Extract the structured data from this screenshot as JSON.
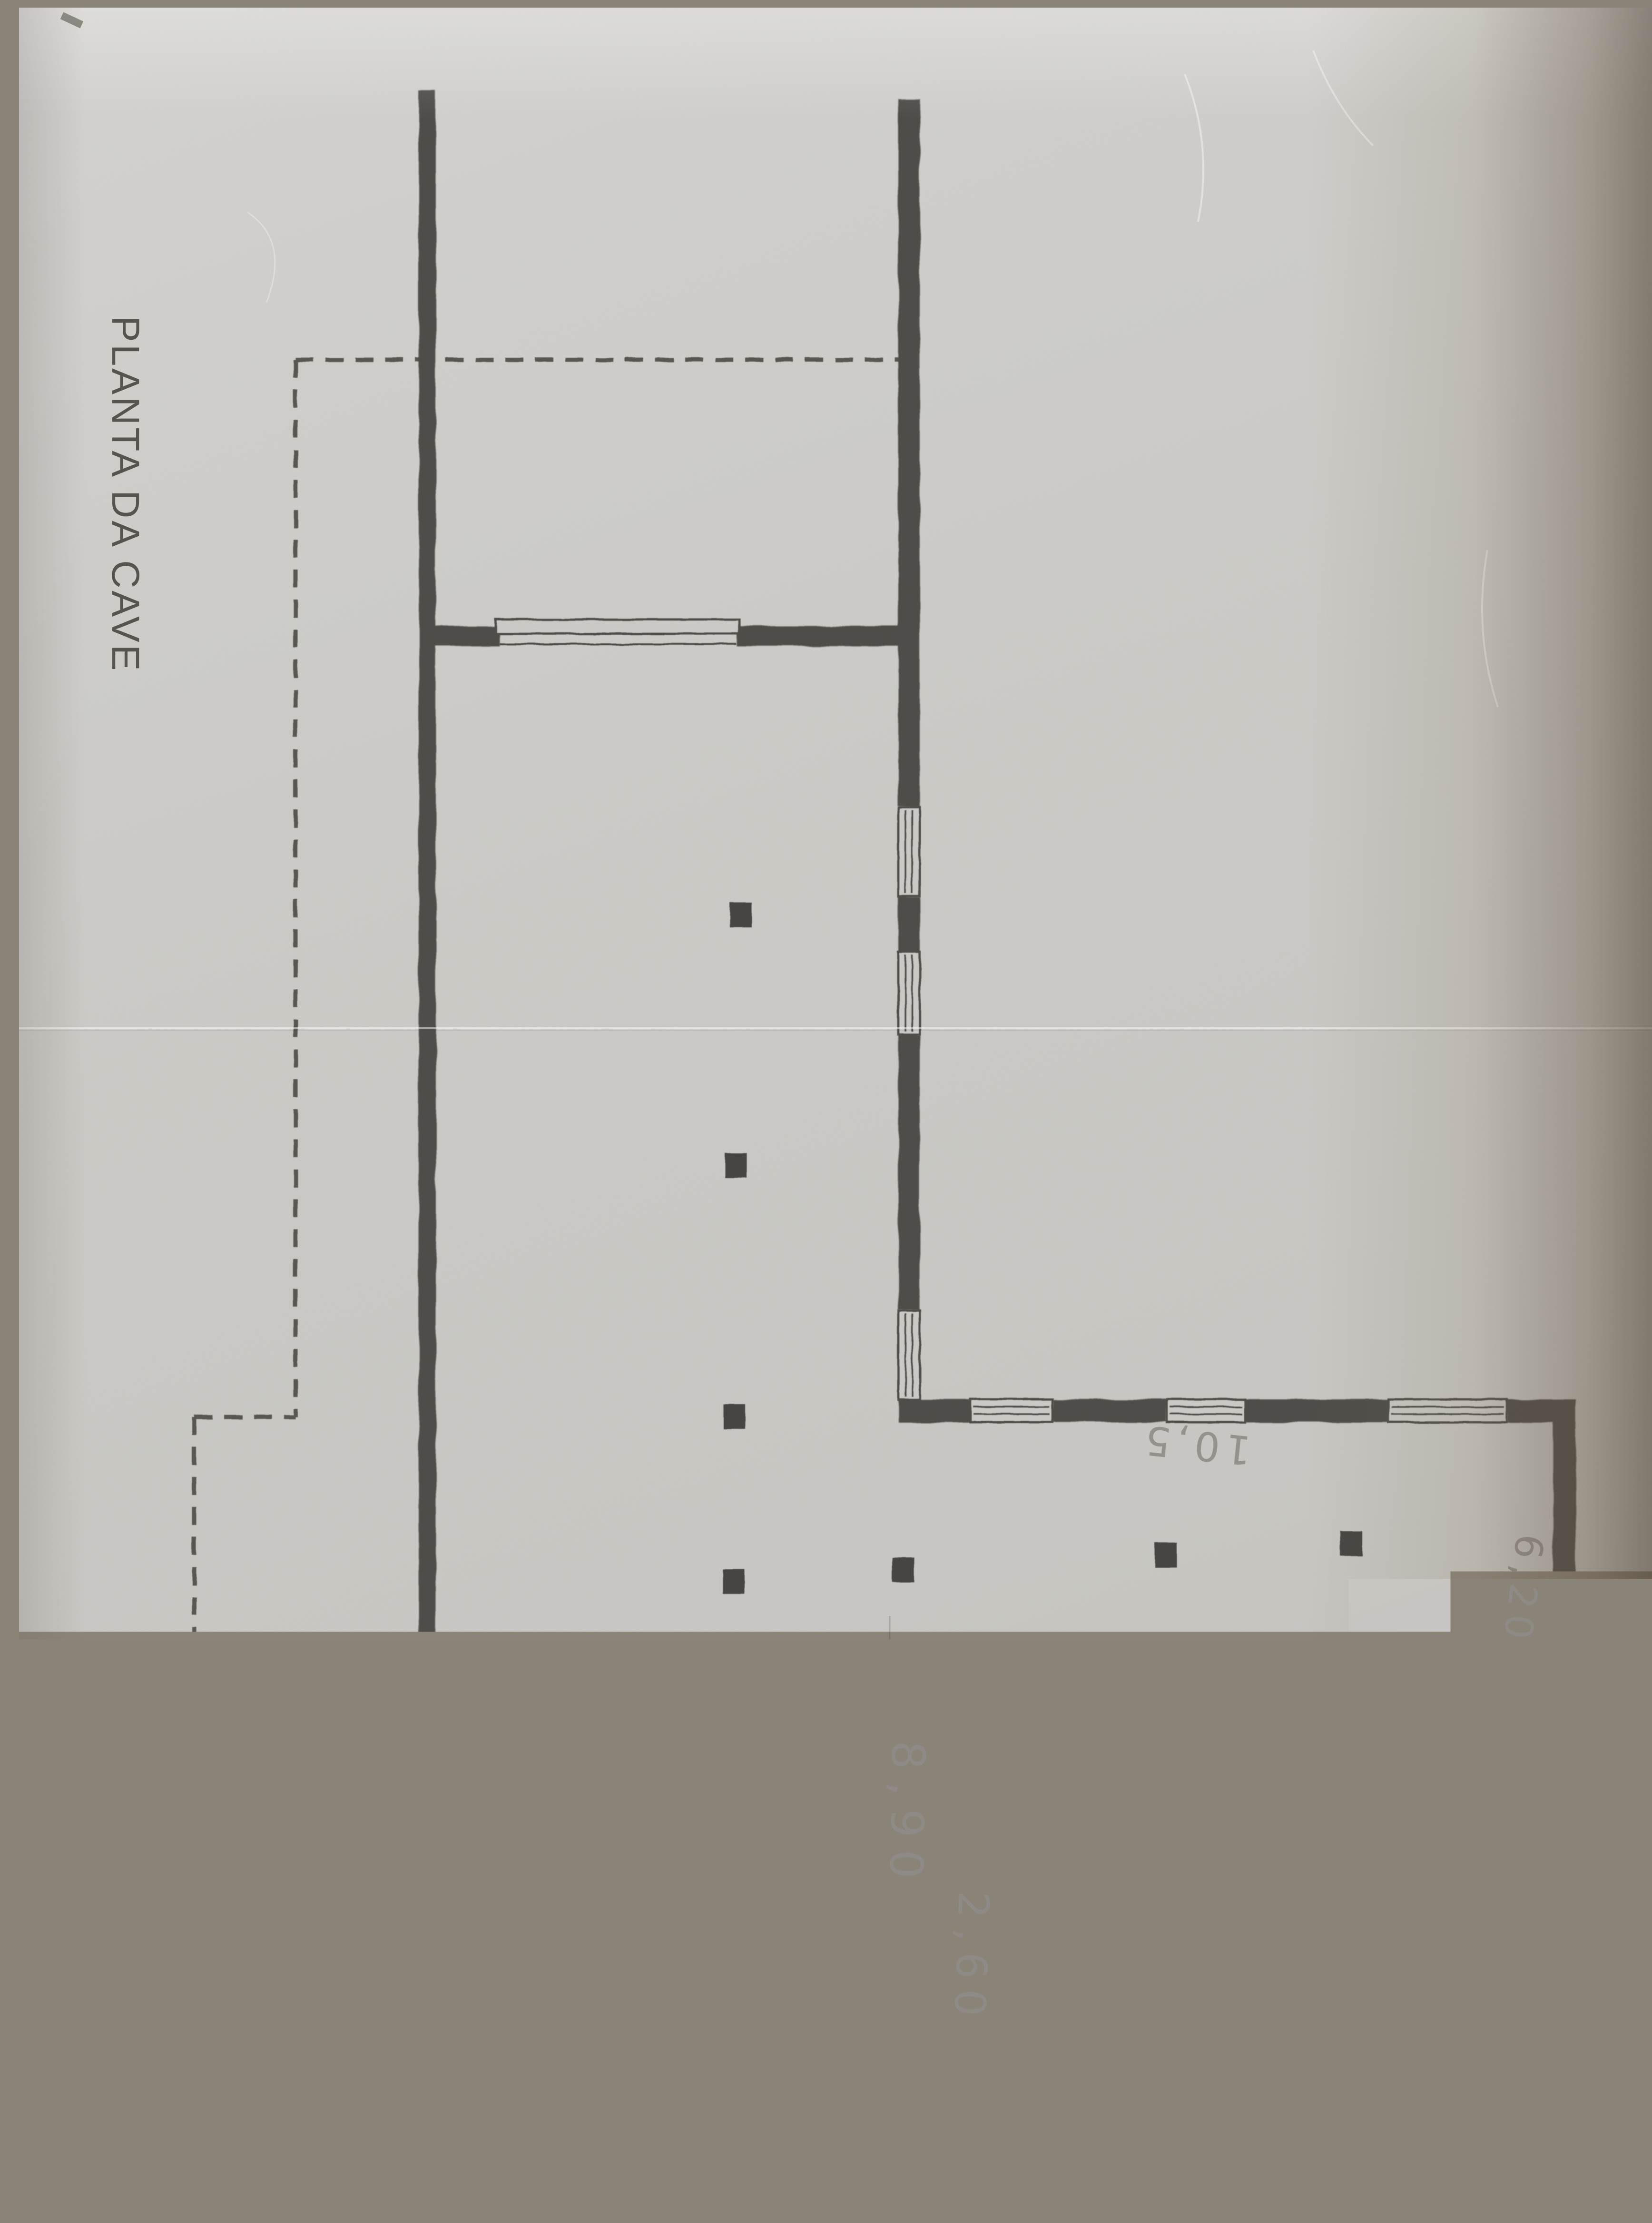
{
  "page_title": "PLANTA DA CAVE",
  "dimension_labels": {
    "dim_8_90": "8,90",
    "dim_2_60": "2,60",
    "dim_10_5": "10,5",
    "dim_6_20": "6,20"
  },
  "colors": {
    "paper": "#cbcac6",
    "wall_ink": "#4d4b47",
    "pencil": "#8f8c87",
    "edge_shadow": "#5c4e3a"
  }
}
